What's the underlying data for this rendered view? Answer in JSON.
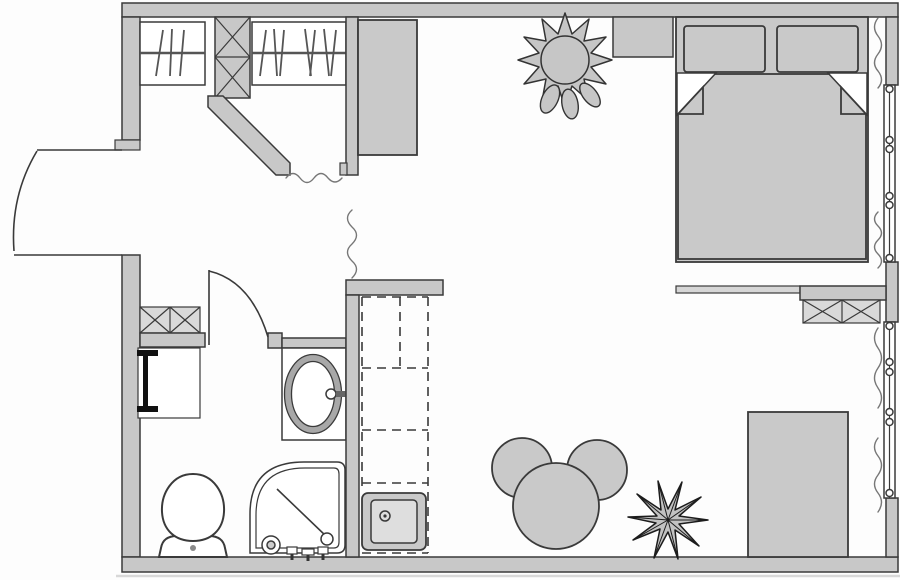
{
  "meta": {
    "title": "Studio apartment floor plan (top view architectural drawing)",
    "drawing_type": "floor-plan",
    "canvas": {
      "width": 900,
      "height": 580
    }
  },
  "colors": {
    "background": "#fdfdfd",
    "wall_fill": "#c8c8c8",
    "furniture_fill": "#c9c9c9",
    "furniture_light": "#dedede",
    "outline": "#3a3a3a",
    "mid_line": "#555555",
    "thin_line": "#777777",
    "plant_dark": "#1c1c1c",
    "faint_line": "#d8d8d8",
    "white": "#ffffff"
  },
  "rooms": [
    {
      "id": "entry-hall",
      "position": "left-middle"
    },
    {
      "id": "walk-in-closet",
      "position": "top-left"
    },
    {
      "id": "bathroom",
      "position": "bottom-left"
    },
    {
      "id": "kitchen-niche",
      "position": "center-bottom"
    },
    {
      "id": "sleeping-area",
      "position": "top-right"
    },
    {
      "id": "living-dining-area",
      "position": "bottom-right"
    }
  ],
  "fixtures": [
    {
      "id": "entrance-door",
      "symbol": "door swing arc, outward, left wall"
    },
    {
      "id": "bathroom-door",
      "symbol": "door swing arc, inward"
    },
    {
      "id": "closet-rails",
      "symbol": "hanging rods with hanger strokes"
    },
    {
      "id": "duct-shaft",
      "symbol": "crossed box column"
    },
    {
      "id": "wardrobe-cabinet",
      "symbol": "grey rectangle"
    },
    {
      "id": "double-bed",
      "symbol": "bed with two pillows and folded blanket corners"
    },
    {
      "id": "windows-right-wall",
      "symbol": "double line with hinge circles"
    },
    {
      "id": "curtains",
      "symbol": "vertical squiggle lines"
    },
    {
      "id": "low-partition",
      "symbol": "thin double-line ledge"
    },
    {
      "id": "storage-cabinet-crossed",
      "symbol": "crossed boxes near partition"
    },
    {
      "id": "washer-cabinet-crossed",
      "symbol": "crossed boxes in bathroom"
    },
    {
      "id": "towel-radiator",
      "symbol": "black bar with end caps"
    },
    {
      "id": "toilet",
      "symbol": "bowl with cistern"
    },
    {
      "id": "corner-shower",
      "symbol": "quarter-round tray with diagonal and drain"
    },
    {
      "id": "washbasin-vanity",
      "symbol": "oval basin with faucet"
    },
    {
      "id": "kitchen-counter",
      "symbol": "dashed counter outline"
    },
    {
      "id": "kitchen-sink",
      "symbol": "square sink with drain"
    },
    {
      "id": "dining-table-round",
      "symbol": "circle"
    },
    {
      "id": "chairs",
      "symbol": "two round blobs"
    },
    {
      "id": "desk-table",
      "symbol": "grey rectangle at bottom right"
    },
    {
      "id": "plant-large",
      "symbol": "fluffy flower top"
    },
    {
      "id": "plant-spiky",
      "symbol": "dark star-shaped palm"
    }
  ]
}
